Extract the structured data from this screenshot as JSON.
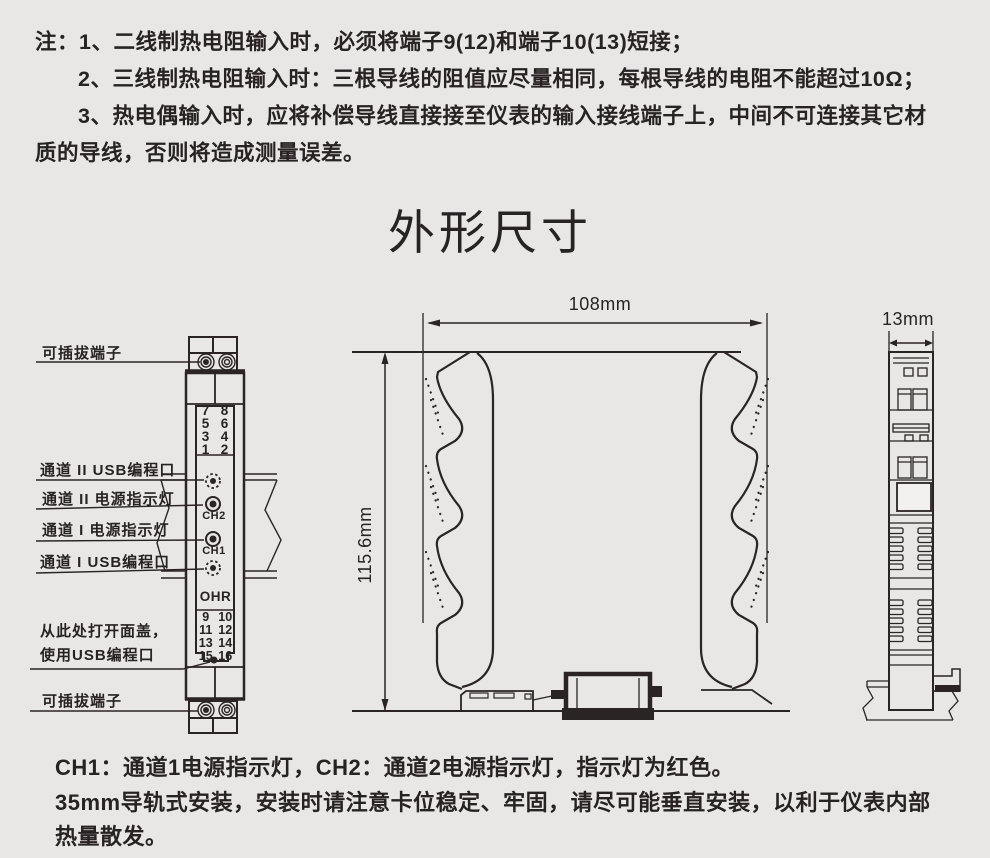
{
  "colors": {
    "background": "#e9e7e5",
    "ink": "#2a2425"
  },
  "notes_top": [
    "注：1、二线制热电阻输入时，必须将端子9(12)和端子10(13)短接；",
    "2、三线制热电阻输入时：三根导线的阻值应尽量相同，每根导线的电阻不能超过10Ω；",
    "3、热电偶输入时，应将补偿导线直接接至仪表的输入接线端子上，中间不可连接其它材",
    "质的导线，否则将造成测量误差。"
  ],
  "title": "外形尺寸",
  "front_view": {
    "labels": {
      "pluggable_terminal_top": "可插拔端子",
      "ch2_usb": "通道 II USB编程口",
      "ch2_power": "通道 II 电源指示灯",
      "ch1_power": "通道 I 电源指示灯",
      "ch1_usb": "通道 I USB编程口",
      "open_cover_line1": "从此处打开面盖，",
      "open_cover_line2": "使用USB编程口",
      "pluggable_terminal_bottom": "可插拔端子"
    },
    "terminals_top": [
      "7",
      "8",
      "5",
      "6",
      "3",
      "4",
      "1",
      "2"
    ],
    "terminals_bottom": [
      "9",
      "10",
      "11",
      "12",
      "13",
      "14",
      "15",
      "16"
    ],
    "led_ch2": "CH2",
    "led_ch1": "CH1",
    "brand": "OHR"
  },
  "dimensions": {
    "width": "108mm",
    "height": "115.6mm",
    "thickness": "13mm"
  },
  "notes_bottom": [
    "CH1：通道1电源指示灯，CH2：通道2电源指示灯，指示灯为红色。",
    "35mm导轨式安装，安装时请注意卡位稳定、牢固，请尽可能垂直安装，以利于仪表内部",
    "热量散发。"
  ]
}
